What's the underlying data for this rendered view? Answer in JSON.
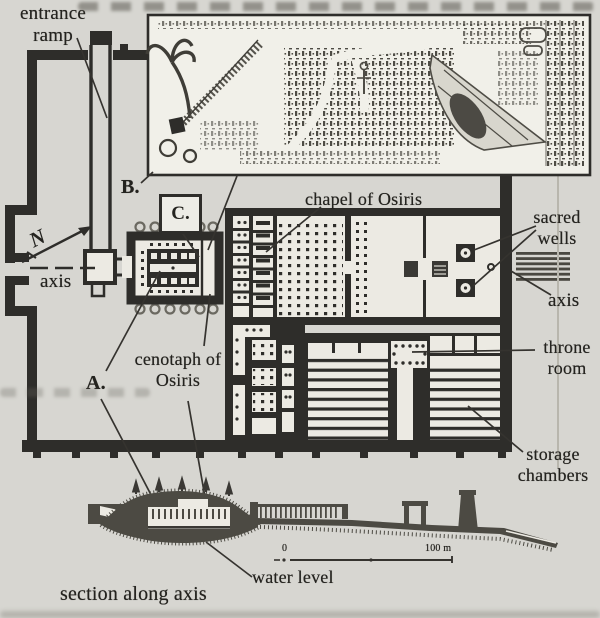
{
  "figure": {
    "kind": "scanned book figure: plan and section of the temple of Seti I and the Osireion at Abydos",
    "labels": {
      "entrance_ramp": "entrance ramp",
      "axis_left": "axis",
      "chapel_of_osiris": "chapel of Osiris",
      "sacred_wells": "sacred wells",
      "axis_right": "axis",
      "throne_room": "throne room",
      "cenotaph_of_osiris": "cenotaph of Osiris",
      "storage_chambers": "storage chambers",
      "water_level": "water level",
      "section_along_axis": "section along axis"
    },
    "markers": {
      "a": "A.",
      "b": "B.",
      "c": "C.",
      "north": "N"
    },
    "scale_bar": {
      "start": "0",
      "end": "100 m"
    },
    "colors": {
      "ink": "#2e2d2a",
      "paper": "#d7d6d1",
      "interior": "#eceae3",
      "inset_paper": "#f1f0e9"
    }
  }
}
